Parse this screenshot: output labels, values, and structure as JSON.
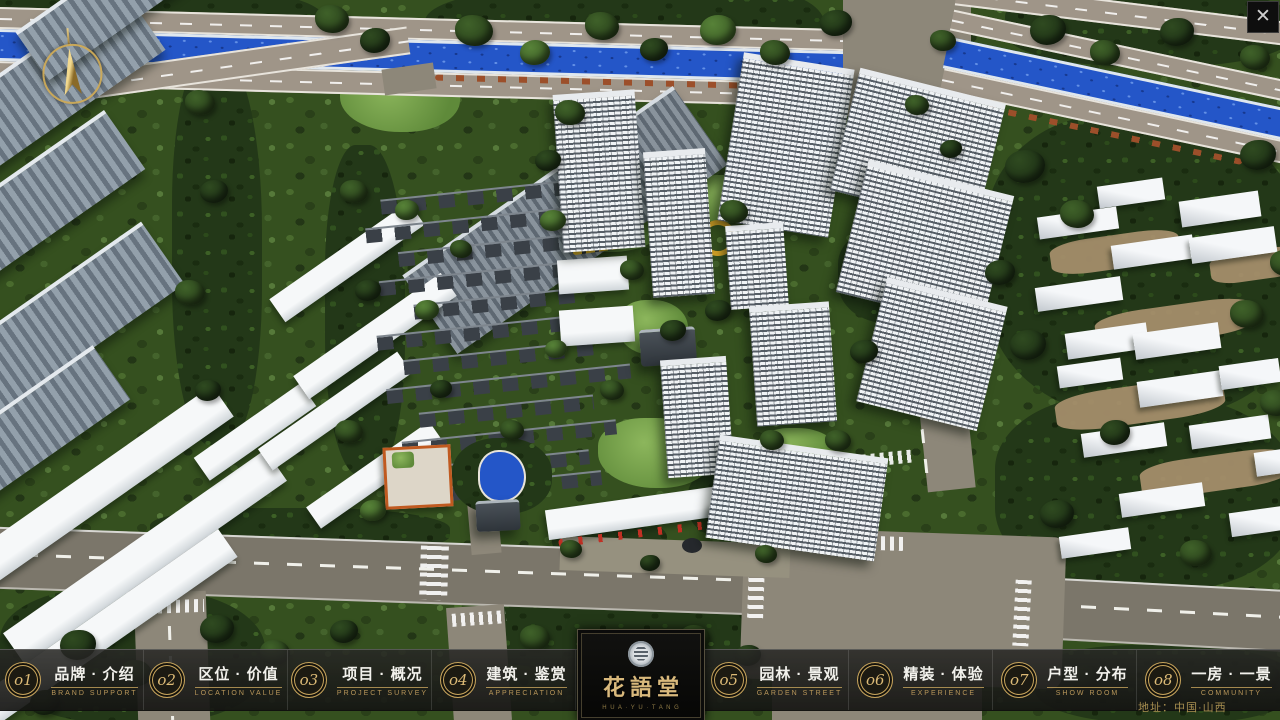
{
  "window": {
    "close_icon": "✕"
  },
  "nav": {
    "items": [
      {
        "num": "o1",
        "zh": "品牌 · 介绍",
        "en": "BRAND SUPPORT"
      },
      {
        "num": "o2",
        "zh": "区位 · 价值",
        "en": "LOCATION VALUE"
      },
      {
        "num": "o3",
        "zh": "项目 · 概况",
        "en": "PROJECT SURVEY"
      },
      {
        "num": "o4",
        "zh": "建筑 · 鉴赏",
        "en": "APPRECIATION"
      },
      {
        "num": "o5",
        "zh": "园林 · 景观",
        "en": "GARDEN STREET"
      },
      {
        "num": "o6",
        "zh": "精装 · 体验",
        "en": "EXPERIENCE"
      },
      {
        "num": "o7",
        "zh": "户型 · 分布",
        "en": "SHOW ROOM"
      },
      {
        "num": "o8",
        "zh": "一房 · 一景",
        "en": "COMMUNITY"
      }
    ]
  },
  "logo": {
    "title": "花語堂",
    "subtitle": "H U A · Y U · T A N G"
  },
  "footer": {
    "address": "地址：中国·山西"
  },
  "colors": {
    "gold": "#c7a45c",
    "nav_bg": "rgba(24,24,22,0.88)",
    "river": "#2456c8",
    "asphalt": "#8d8779"
  }
}
